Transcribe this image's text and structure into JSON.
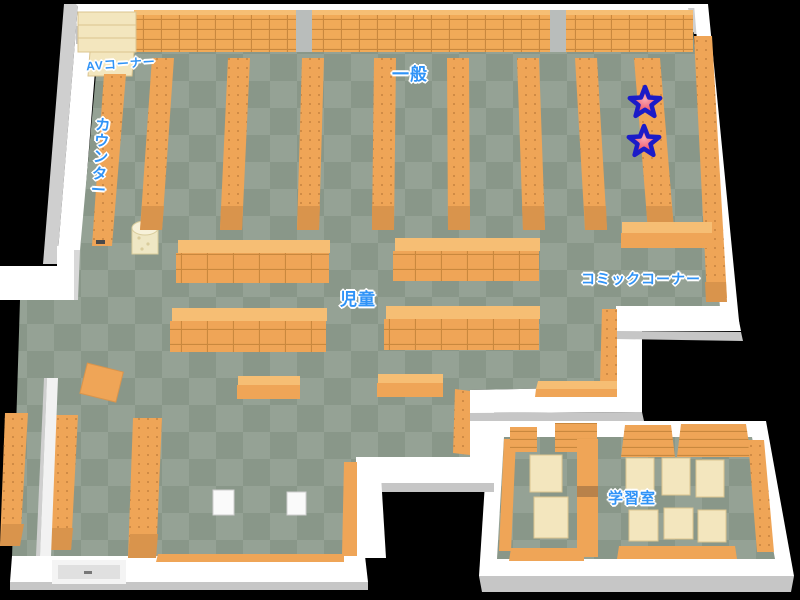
{
  "map": {
    "type": "library-floor-map",
    "areas": {
      "av_corner": {
        "label": "AVコーナー"
      },
      "general": {
        "label": "一般"
      },
      "counter": {
        "label": "カウンター"
      },
      "children": {
        "label": "児童"
      },
      "comic_corner": {
        "label": "コミックコーナー"
      },
      "study_room": {
        "label": "学習室"
      }
    },
    "markers": [
      {
        "id": "star-1",
        "type": "star"
      },
      {
        "id": "star-2",
        "type": "star"
      }
    ],
    "colors": {
      "bg": "#000000",
      "wall": "#ffffff",
      "wall_shadow": "#c6c6c6",
      "wall_gray": "#cfcfcf",
      "floor_light": "#95a295",
      "floor_dark": "#899789",
      "shelf_front": "#efa557",
      "shelf_top": "#f6be74",
      "shelf_line": "#c9883e",
      "shelf_cap": "#d9944c",
      "cream": "#f3e6be",
      "cream_line": "#dbc48f",
      "gray_pillar": "#b9bdbb",
      "label_blue": "#2f93f7",
      "star_stroke": "#1b1bc8",
      "partition_door": "#b9824a"
    }
  }
}
